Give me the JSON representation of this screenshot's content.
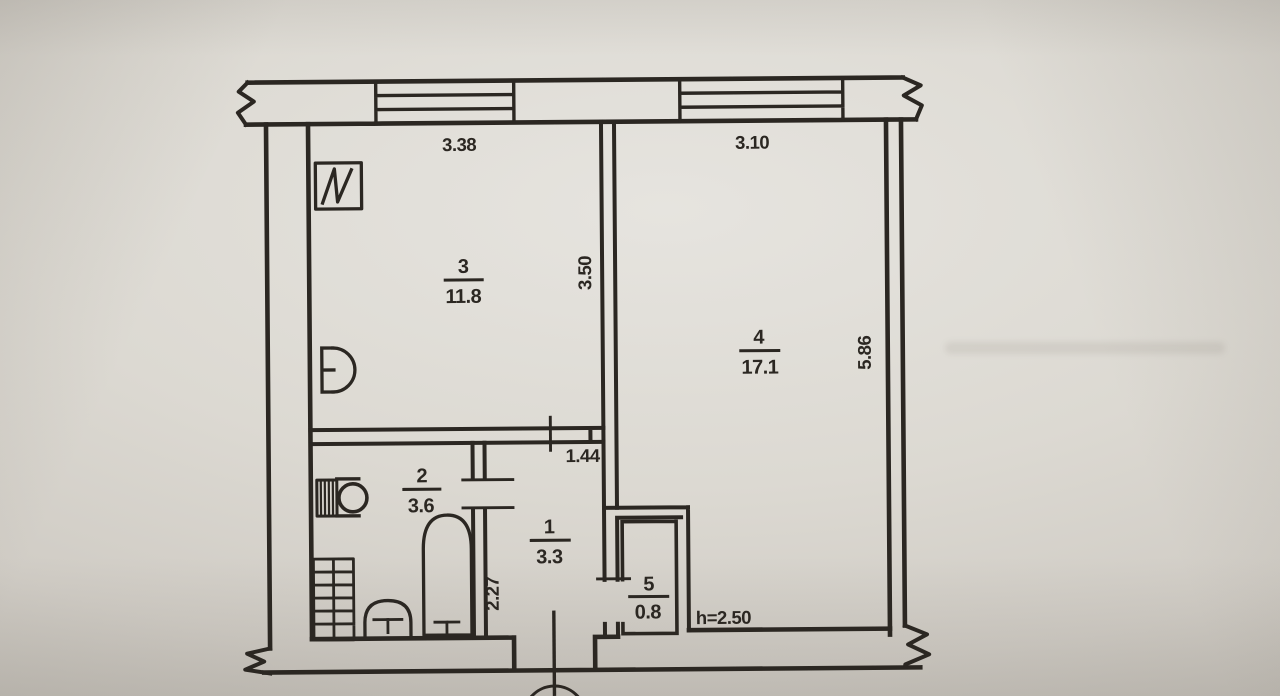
{
  "document": {
    "kind": "apartment floor plan (BTI technical drawing, photographed)",
    "colors": {
      "paper": "#dcd9d2",
      "ink": "#2b2722"
    }
  },
  "rooms": [
    {
      "number": "3",
      "area": "11.8"
    },
    {
      "number": "4",
      "area": "17.1"
    },
    {
      "number": "2",
      "area": "3.6"
    },
    {
      "number": "1",
      "area": "3.3"
    },
    {
      "number": "5",
      "area": "0.8"
    }
  ],
  "dimensions": {
    "room3_top": "3.38",
    "room3_side": "3.50",
    "room4_top": "3.10",
    "room4_side": "5.86",
    "hall_top": "1.44",
    "hall_side": "2.27",
    "height_note": "h=2.50"
  },
  "icons": {
    "vent_grille": "square with N-zigzag (ventilation shaft)",
    "kitchen_sink": "D-shaped wall sink",
    "washing_machine": "hatched box with drum circle",
    "bathtub": "rounded-top tub with drain tee",
    "toilet": "dome with tee",
    "radiator_grid": "grid of tiles (shaft)",
    "entrance_door": "swing arc at bottom opening"
  }
}
